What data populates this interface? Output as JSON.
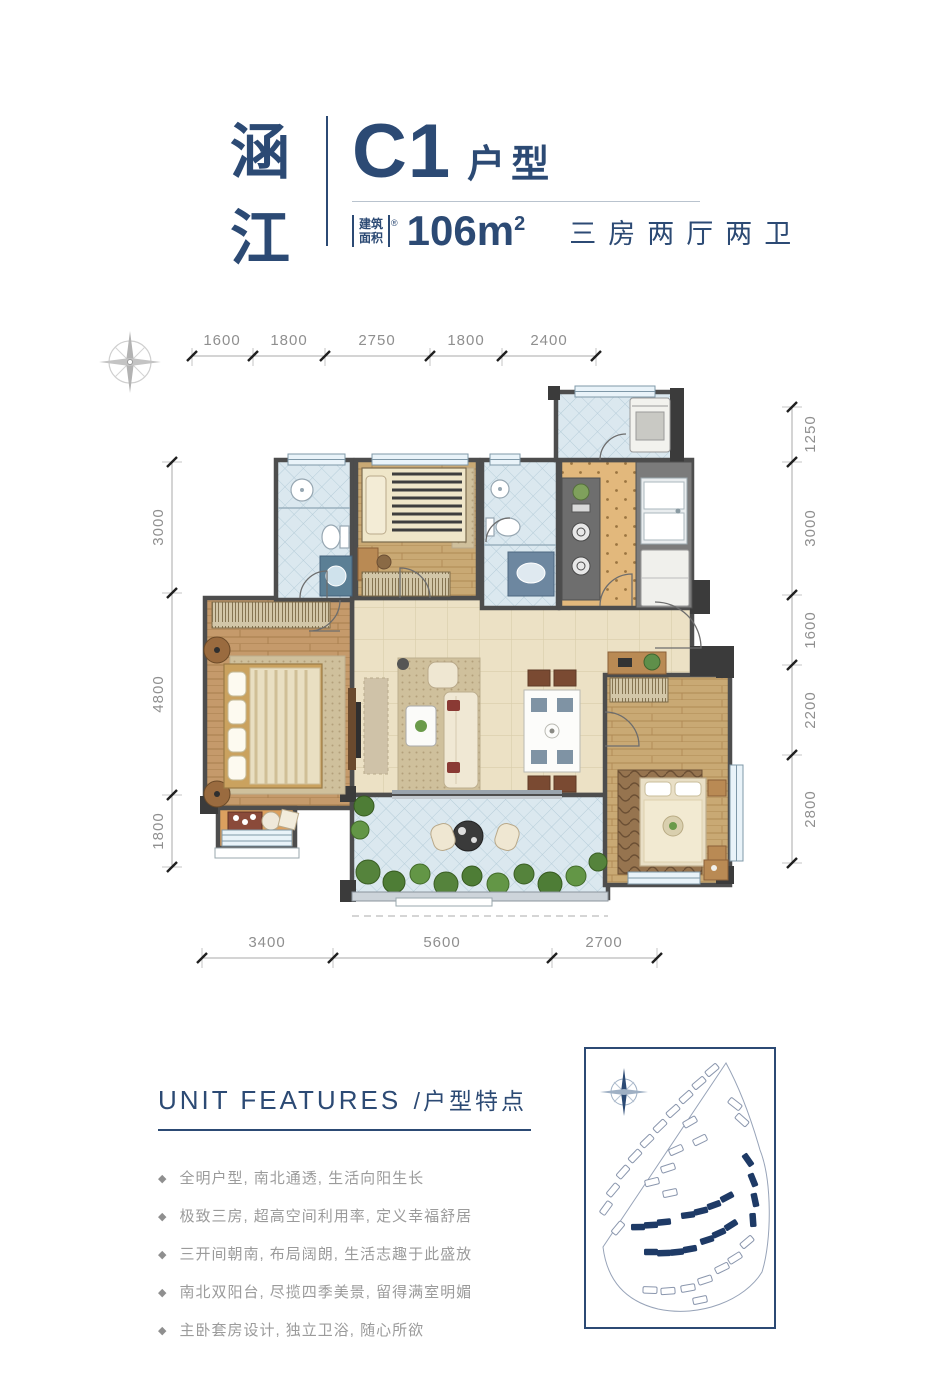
{
  "header": {
    "brand_chars": [
      "涵",
      "江"
    ],
    "unit_code": "C1",
    "unit_type_label": "户型",
    "area_box_line1": "建筑",
    "area_box_line2": "面积",
    "area_reg_mark": "®",
    "area_value": "106m",
    "area_superscript": "2",
    "layout_text": "三房两厅两卫"
  },
  "floor_plan": {
    "dims_top": [
      "1600",
      "1800",
      "2750",
      "1800",
      "2400"
    ],
    "dims_left": [
      "3000",
      "4800",
      "1800"
    ],
    "dims_right": [
      "1250",
      "3000",
      "1600",
      "2200",
      "2800"
    ],
    "dims_bottom": [
      "3400",
      "5600",
      "2700"
    ]
  },
  "features": {
    "title_en": "UNIT FEATURES",
    "title_zh": "/户型特点",
    "bullet": "◆",
    "items": [
      "全明户型, 南北通透, 生活向阳生长",
      "极致三房, 超高空间利用率, 定义幸福舒居",
      "三开间朝南, 布局阔朗, 生活志趣于此盛放",
      "南北双阳台, 尽揽四季美景, 留得满室明媚",
      "主卧套房设计, 独立卫浴, 随心所欲"
    ]
  },
  "icons": {
    "plan_compass": "compass-rose",
    "map_compass": "compass-rose"
  },
  "colors": {
    "brand_navy": "#2c4a74",
    "dim_gray": "#8f8f8f",
    "wall_gray": "#4d4d4d",
    "site_highlight_navy": "#1e3a66"
  }
}
